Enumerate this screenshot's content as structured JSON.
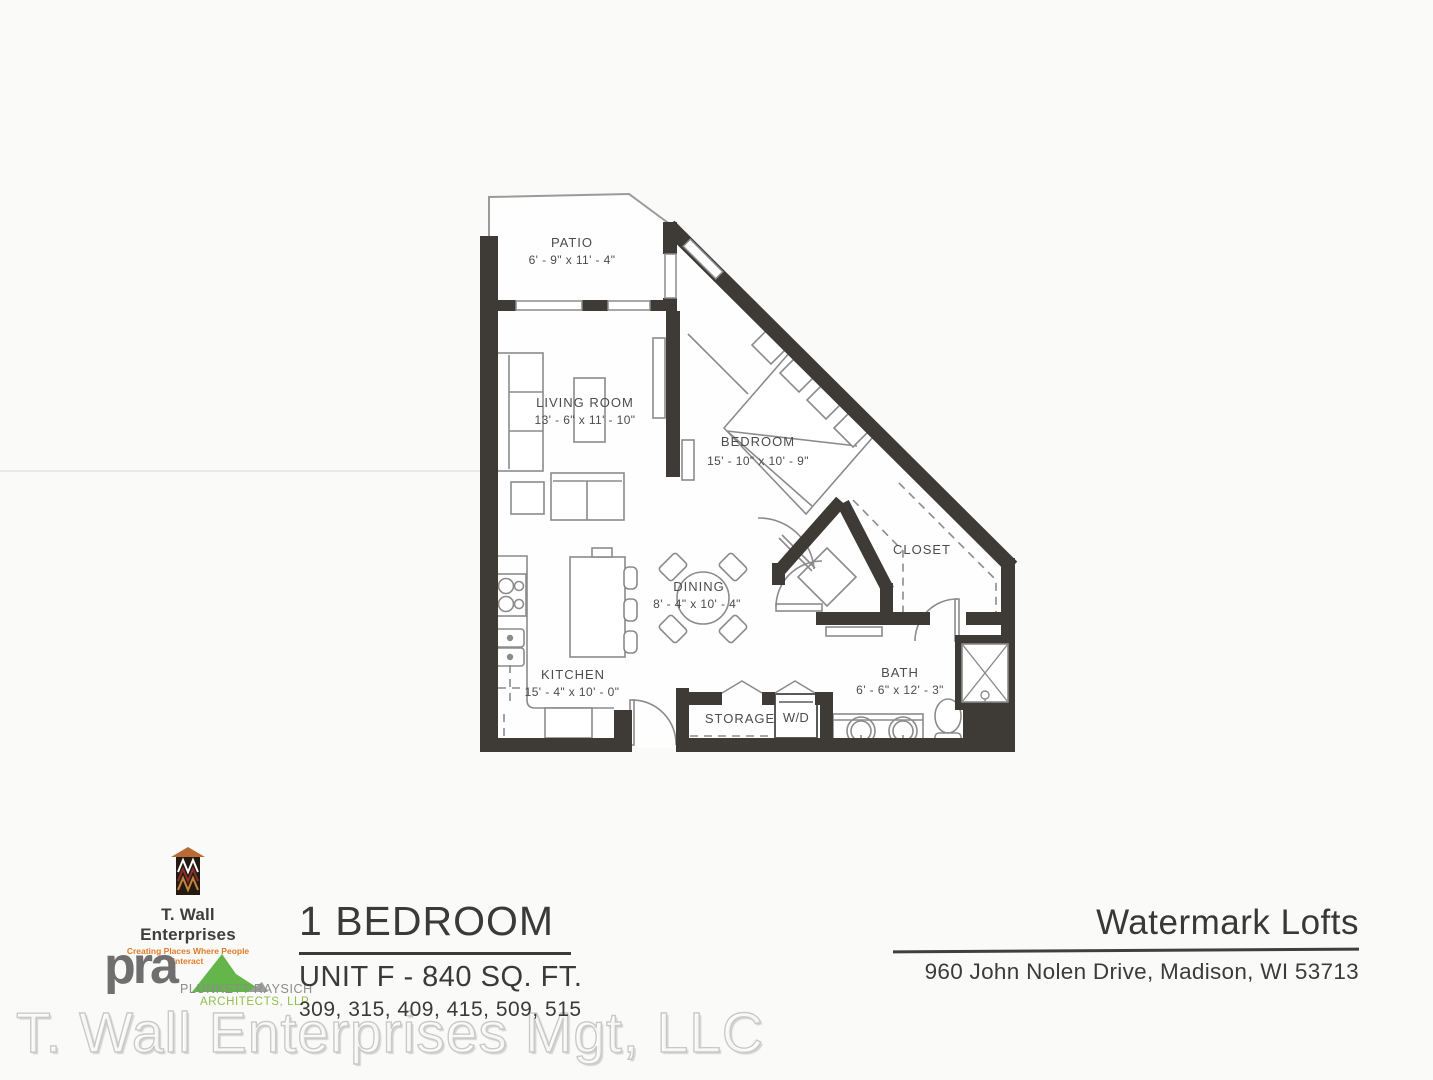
{
  "floor_plan": {
    "rooms": {
      "patio": {
        "name": "PATIO",
        "dims": "6' - 9\" x 11' - 4\""
      },
      "living_room": {
        "name": "LIVING ROOM",
        "dims": "13' - 6\" x 11' - 10\""
      },
      "bedroom": {
        "name": "BEDROOM",
        "dims": "15' - 10\" x 10' - 9\""
      },
      "closet": {
        "name": "CLOSET"
      },
      "dining": {
        "name": "DINING",
        "dims": "8' - 4\" x 10' - 4\""
      },
      "kitchen": {
        "name": "KITCHEN",
        "dims": "15' - 4\" x 10' - 0\""
      },
      "bath": {
        "name": "BATH",
        "dims": "6' - 6\" x 12' - 3\""
      },
      "storage": {
        "name": "STORAGE"
      },
      "washer_dryer": {
        "name": "W/D"
      }
    }
  },
  "branding": {
    "developer": {
      "name": "T. Wall Enterprises",
      "tagline": "Creating Places Where People Interact"
    },
    "architect": {
      "abbrev": "pra",
      "firm_line1": "PLUNKETT RAYSICH",
      "firm_line2": "ARCHITECTS, LLP"
    }
  },
  "unit_info": {
    "bedroom_count": "1 BEDROOM",
    "unit_label": "UNIT F - 840 SQ. FT.",
    "unit_numbers": "309, 315, 409, 415, 509, 515"
  },
  "property": {
    "name": "Watermark Lofts",
    "address": "960 John Nolen Drive, Madison, WI 53713"
  },
  "watermark": {
    "text": "T. Wall Enterprises Mgt, LLC"
  },
  "colors": {
    "paper": "#fafaf8",
    "wall": "#3e3a35",
    "plan_line": "#8b8b8b",
    "plan_text": "#4c4c4c",
    "accent_orange": "#e07b28",
    "accent_green": "#6ab04c",
    "logo_gray": "#6f6f6f",
    "watermark_gray": "#c9c9c6"
  }
}
